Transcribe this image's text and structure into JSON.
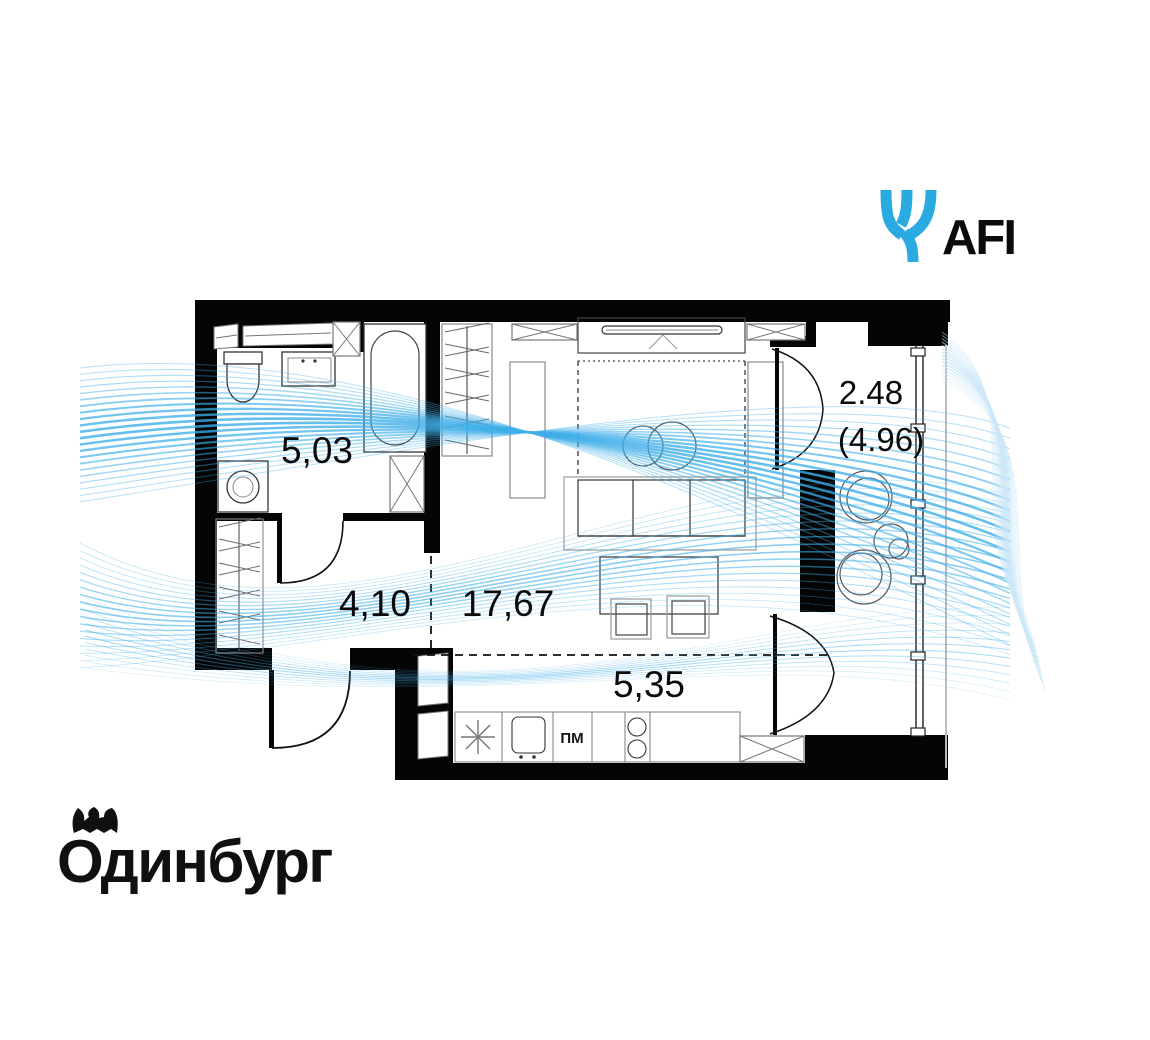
{
  "header": {
    "afi_logo_text": "AFI"
  },
  "footer": {
    "developer_logo_text": "Одинбург"
  },
  "colors": {
    "accent_blue": "#29ABE2",
    "swoosh_blue": "#3FAEE8",
    "swoosh_light": "#CBE7F8",
    "wall_black": "#050505"
  },
  "floor_plan": {
    "rooms": [
      {
        "id": "bathroom",
        "area": "5,03"
      },
      {
        "id": "hallway",
        "area": "4,10"
      },
      {
        "id": "living-room",
        "area": "17,67"
      },
      {
        "id": "kitchen",
        "area": "5,35"
      },
      {
        "id": "balcony",
        "area": "2.48",
        "area_total": "(4.96)"
      }
    ],
    "appliance_labels": {
      "dishwasher": "ПМ"
    }
  }
}
